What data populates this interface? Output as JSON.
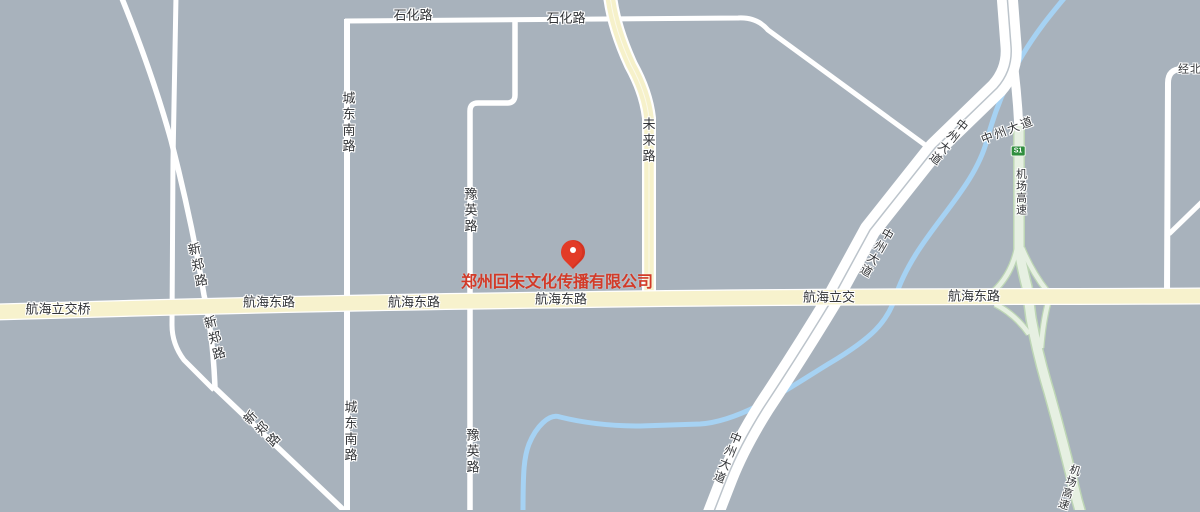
{
  "map_title": "Zhengzhou Hanghai East Road area street map",
  "colors": {
    "background": "#a8b2bc",
    "road_white": "#ffffff",
    "road_yellow": "#f7f2cd",
    "road_green_fill": "#e6f0e2",
    "road_green_edge": "#bdd6b5",
    "river_blue": "#a6d2f3",
    "label_text": "#333538",
    "company_red": "#d23a28",
    "badge_green": "#2f8e3e",
    "marker_red": "#e23b27"
  },
  "roads": {
    "shihua": "石化路",
    "chengdongnan": "城东南路",
    "yuying": "豫英路",
    "weilai": "未来路",
    "xinzheng": "新郑路",
    "hanghai_east": "航海东路",
    "hanghai_lijiao_qiao": "航海立交桥",
    "hanghai_lijiao": "航海立交",
    "zhongzhou": "中州大道",
    "jichang_expressway": "机场高速",
    "jingbei": "经北",
    "s1": "S1"
  },
  "poi": {
    "company": "郑州回未文化传播有限公司"
  }
}
